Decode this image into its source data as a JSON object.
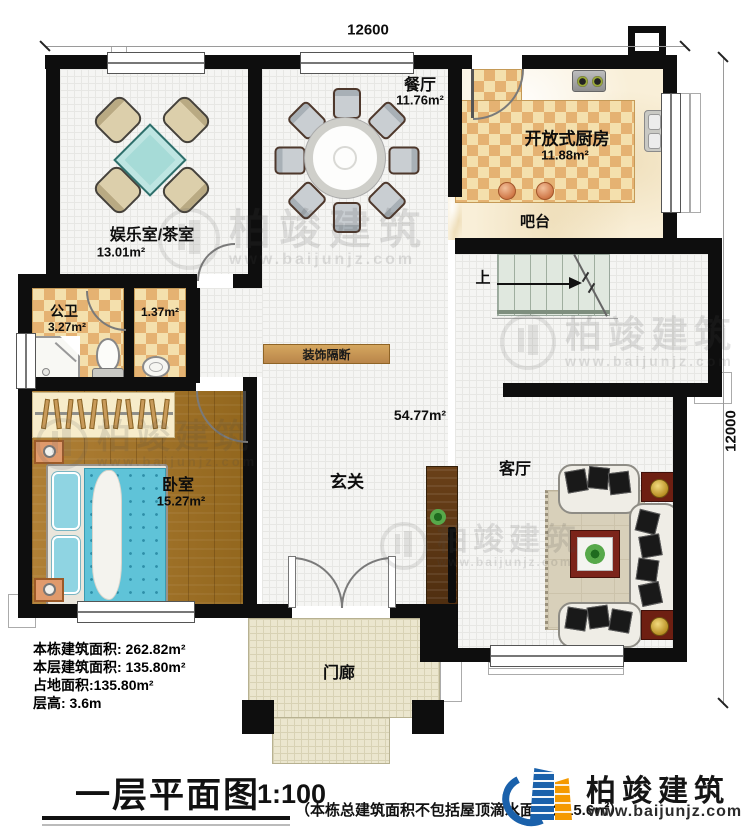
{
  "dimensions": {
    "top": "12600",
    "right": "12000"
  },
  "rooms": {
    "entertainment": {
      "name": "娱乐室/茶室",
      "area": "13.01m²"
    },
    "dining": {
      "name": "餐厅",
      "area": "11.76m²"
    },
    "kitchen": {
      "name": "开放式厨房",
      "area": "11.88m²"
    },
    "bar": {
      "name": "吧台"
    },
    "bathroom": {
      "name": "公卫",
      "area": "3.27m²"
    },
    "utility": {
      "area": "1.37m²"
    },
    "bedroom": {
      "name": "卧室",
      "area": "15.27m²"
    },
    "foyer": {
      "name": "玄关"
    },
    "living": {
      "name": "客厅"
    },
    "porch": {
      "name": "门廊"
    },
    "hall": {
      "area": "54.77m²"
    },
    "partition": {
      "name": "装饰隔断"
    },
    "stairs": {
      "label": "上"
    }
  },
  "stats": {
    "building_total": "本栋建筑面积: 262.82m²",
    "floor_area": "本层建筑面积: 135.80m²",
    "footprint": "占地面积:135.80m²",
    "height": "层高: 3.6m"
  },
  "titleblock": {
    "title": "一层平面图",
    "scale": "1:100",
    "note": "（本栋总建筑面积不包括屋顶滴水面积：15.6㎡）"
  },
  "brand": {
    "name": "柏竣建筑",
    "url": "www.baijunjz.com"
  },
  "watermark": {
    "name": "柏竣建筑",
    "url": "www.baijunjz.com"
  },
  "colors": {
    "wall": "#0e0e0e",
    "checker": "#e5b272",
    "wood": "#a3762f",
    "brand_blue": "#1a61ab",
    "brand_orange": "#f59a00"
  }
}
